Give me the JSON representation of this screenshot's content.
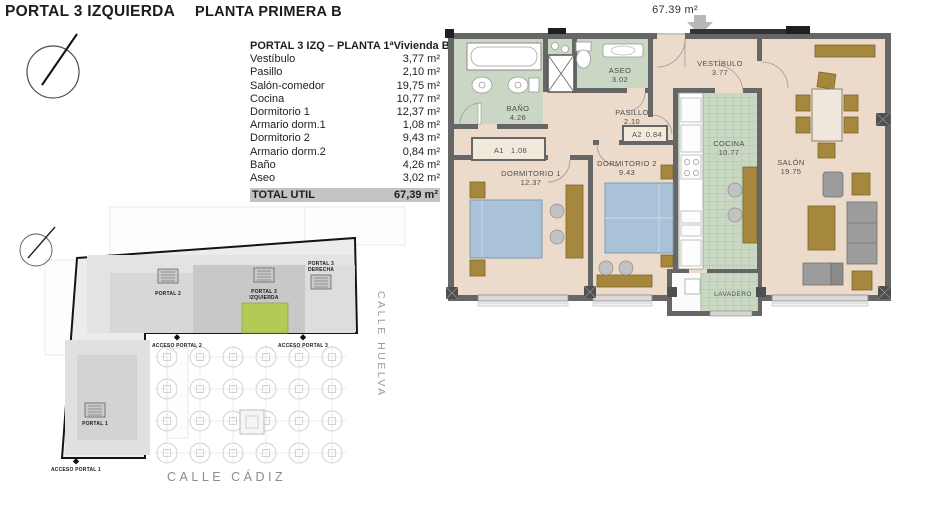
{
  "page": {
    "title_left": "PORTAL 3 IZQUIERDA",
    "title_right": "PLANTA PRIMERA B"
  },
  "area_table": {
    "header_left": "PORTAL 3 IZQ – PLANTA 1ª",
    "header_right": "Vivienda B",
    "rows": [
      {
        "label": "Vestíbulo",
        "value": "3,77 m²"
      },
      {
        "label": "Pasillo",
        "value": "2,10 m²"
      },
      {
        "label": "Salón-comedor",
        "value": "19,75 m²"
      },
      {
        "label": "Cocina",
        "value": "10,77 m²"
      },
      {
        "label": "Dormitorio 1",
        "value": "12,37 m²"
      },
      {
        "label": "Armario dorm.1",
        "value": "1,08 m²"
      },
      {
        "label": "Dormitorio 2",
        "value": "9,43 m²"
      },
      {
        "label": "Armario dorm.2",
        "value": "0,84 m²"
      },
      {
        "label": "Baño",
        "value": "4,26 m²"
      },
      {
        "label": "Aseo",
        "value": "3,02 m²"
      }
    ],
    "total_label": "TOTAL UTIL",
    "total_value": "67,39 m²"
  },
  "floor_plan": {
    "total_area": "67.39 m²",
    "rooms": {
      "bano": {
        "name": "BAÑO",
        "area": "4.26"
      },
      "aseo": {
        "name": "ASEO",
        "area": "3.02"
      },
      "vestibulo": {
        "name": "VESTÍBULO",
        "area": "3.77"
      },
      "pasillo": {
        "name": "PASILLO",
        "area": "2.10"
      },
      "cocina": {
        "name": "COCINA",
        "area": "10.77"
      },
      "dorm1": {
        "name": "DORMITORIO 1",
        "area": "12.37"
      },
      "dorm2": {
        "name": "DORMITORIO 2",
        "area": "9.43"
      },
      "salon": {
        "name": "SALÓN",
        "area": "19.75"
      },
      "lavadero": {
        "name": "LAVADERO"
      },
      "a1": {
        "name": "A1",
        "area": "1.08"
      },
      "a2": {
        "name": "A2",
        "area": "0.84"
      }
    }
  },
  "site_plan": {
    "portal_2": "PORTAL 2",
    "portal_3_izq_line1": "PORTAL 3",
    "portal_3_izq_line2": "IZQUIERDA",
    "portal_3_der_line1": "PORTAL 3",
    "portal_3_der_line2": "DERECHA",
    "portal_1": "PORTAL 1",
    "acceso_2": "ACCESO PORTAL 2",
    "acceso_3": "ACCESO PORTAL 3",
    "acceso_1": "ACCESO PORTAL 1",
    "street_right": "CALLE HUELVA",
    "street_bottom": "CALLE CÁDIZ"
  },
  "colors": {
    "floor": "#ecdbca",
    "wet_room": "#cbd7c5",
    "kitchen_tile": "#c9d8c3",
    "bed": "#a9c2d8",
    "wood": "#a5883d",
    "gray_furniture": "#9c9c9c",
    "wall": "#666666",
    "site_highlight": "#b4ca57"
  }
}
